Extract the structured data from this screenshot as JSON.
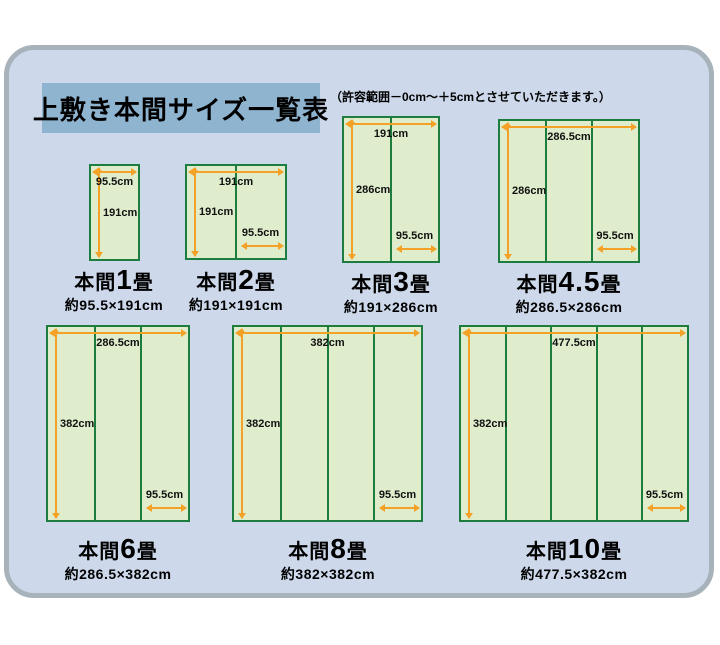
{
  "page": {
    "title": "上敷き本間サイズ一覧表",
    "note": "（許容範囲－0cm～＋5cmとさせていただきます。）"
  },
  "colors": {
    "panel_bg": "#cdd9eb",
    "panel_border": "#a8b2ba",
    "title_bg": "#8fb4d0",
    "mat_fill": "#dfedcc",
    "mat_border": "#1d7d3f",
    "arrow_orange": "#f4a128",
    "text": "#000000"
  },
  "mats": [
    {
      "title_prefix": "本間",
      "title_num": "1",
      "title_suffix": "畳",
      "size_label": "約95.5×191cm",
      "columns": 1,
      "top_label": "95.5cm",
      "left_label": "191cm",
      "bottom_label": "",
      "box": {
        "x": 89,
        "y": 164,
        "w": 51,
        "h": 97
      },
      "caption": {
        "cx": 114,
        "y": 266
      }
    },
    {
      "title_prefix": "本間",
      "title_num": "2",
      "title_suffix": "畳",
      "size_label": "約191×191cm",
      "columns": 2,
      "top_label": "191cm",
      "left_label": "191cm",
      "bottom_label": "95.5cm",
      "box": {
        "x": 185,
        "y": 164,
        "w": 102,
        "h": 96
      },
      "caption": {
        "cx": 236,
        "y": 266
      }
    },
    {
      "title_prefix": "本間",
      "title_num": "3",
      "title_suffix": "畳",
      "size_label": "約191×286cm",
      "columns": 2,
      "top_label": "191cm",
      "left_label": "286cm",
      "bottom_label": "95.5cm",
      "box": {
        "x": 342,
        "y": 116,
        "w": 98,
        "h": 147
      },
      "caption": {
        "cx": 391,
        "y": 268
      }
    },
    {
      "title_prefix": "本間",
      "title_num": "4.5",
      "title_suffix": "畳",
      "size_label": "約286.5×286cm",
      "columns": 3,
      "top_label": "286.5cm",
      "left_label": "286cm",
      "bottom_label": "95.5cm",
      "box": {
        "x": 498,
        "y": 119,
        "w": 142,
        "h": 144
      },
      "caption": {
        "cx": 569,
        "y": 268
      }
    },
    {
      "title_prefix": "本間",
      "title_num": "6",
      "title_suffix": "畳",
      "size_label": "約286.5×382cm",
      "columns": 3,
      "top_label": "286.5cm",
      "left_label": "382cm",
      "bottom_label": "95.5cm",
      "box": {
        "x": 46,
        "y": 325,
        "w": 144,
        "h": 197
      },
      "caption": {
        "cx": 118,
        "y": 535
      }
    },
    {
      "title_prefix": "本間",
      "title_num": "8",
      "title_suffix": "畳",
      "size_label": "約382×382cm",
      "columns": 4,
      "top_label": "382cm",
      "left_label": "382cm",
      "bottom_label": "95.5cm",
      "box": {
        "x": 232,
        "y": 325,
        "w": 191,
        "h": 197
      },
      "caption": {
        "cx": 328,
        "y": 535
      }
    },
    {
      "title_prefix": "本間",
      "title_num": "10",
      "title_suffix": "畳",
      "size_label": "約477.5×382cm",
      "columns": 5,
      "top_label": "477.5cm",
      "left_label": "382cm",
      "bottom_label": "95.5cm",
      "box": {
        "x": 459,
        "y": 325,
        "w": 230,
        "h": 197
      },
      "caption": {
        "cx": 574,
        "y": 535
      }
    }
  ]
}
